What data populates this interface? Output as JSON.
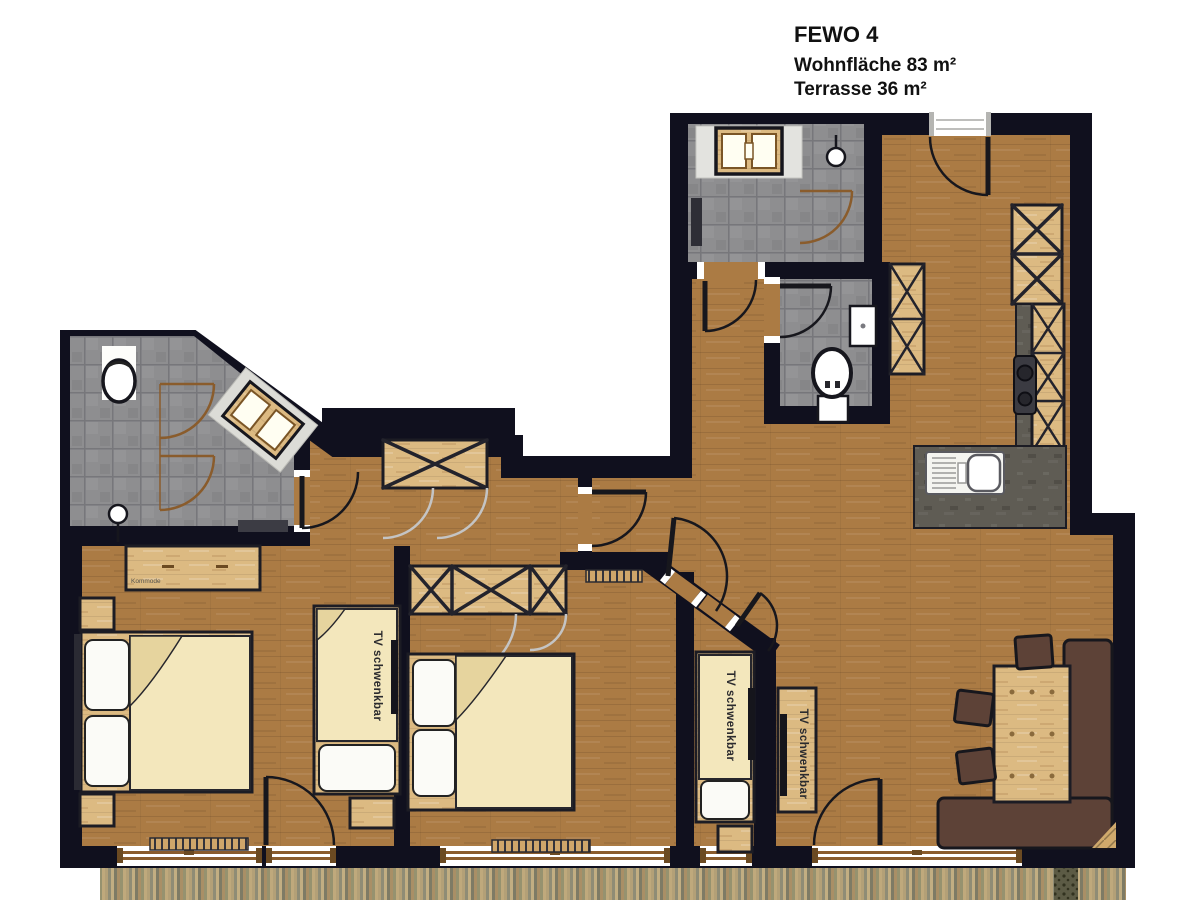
{
  "title_block": {
    "name": "FEWO 4",
    "living_area": "Wohnfläche 83 m²",
    "terrace_area": "Terrasse 36 m²"
  },
  "furniture_labels": {
    "tv": "TV schwenkbar",
    "dresser": "Kommode"
  },
  "colors": {
    "wall": "#10101e",
    "wood_floor": "#ab7b44",
    "furniture_wood": "#dcba82",
    "tile": "#8e8e90",
    "countertop": "#5f5c54",
    "duvet": "#f3e7bc",
    "pillow": "#fbfbf7",
    "bench": "#5d4237",
    "terrace_deck": "#a8946c",
    "door_arc": "#17171d",
    "shower_arc_brown": "#8a5c2c",
    "cabinet_arc_gray": "#c4c4c4"
  }
}
